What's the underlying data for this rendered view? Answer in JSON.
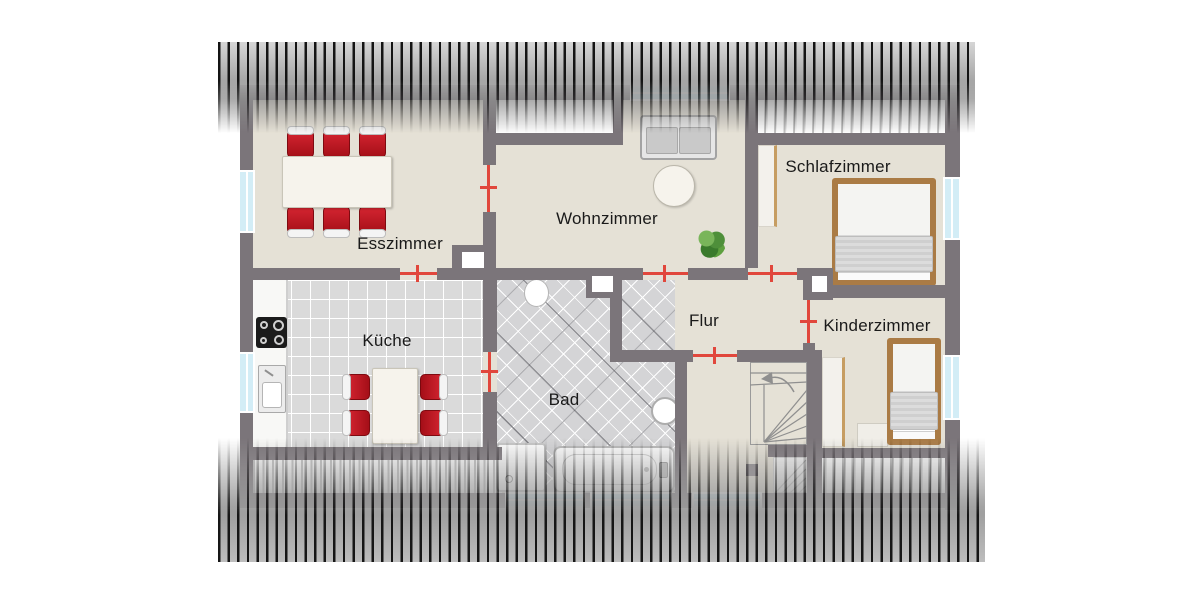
{
  "rooms": [
    {
      "id": "esszimmer",
      "label": "Esszimmer"
    },
    {
      "id": "wohnzimmer",
      "label": "Wohnzimmer"
    },
    {
      "id": "schlafzimmer",
      "label": "Schlafzimmer"
    },
    {
      "id": "kueche",
      "label": "Küche"
    },
    {
      "id": "bad",
      "label": "Bad"
    },
    {
      "id": "flur",
      "label": "Flur"
    },
    {
      "id": "kinderzimmer",
      "label": "Kinderzimmer"
    }
  ],
  "colors": {
    "wall": "#7b757a",
    "floor": "#e5e1d6",
    "kitchen_tile": "#dadada",
    "bath_tile": "#d4d4d6",
    "window_glass": "#d3edf6",
    "door_marker": "#e1473c",
    "chair_red": "#c01b24",
    "bed_frame": "#aa7b45",
    "wardrobe_edge": "#c69d62",
    "sofa_gray": "#d6d6d6",
    "plant_green": "#4e8f3a",
    "label_text": "#1a1a1a"
  },
  "furniture_icons": [
    "dining-table",
    "dining-chair",
    "sofa",
    "coffee-table",
    "plant",
    "double-bed",
    "single-bed",
    "wardrobe",
    "kitchen-counter",
    "cooktop",
    "kitchen-sink",
    "kitchen-table",
    "kitchen-chair",
    "toilet",
    "shower",
    "bathtub",
    "washbasin",
    "staircase",
    "desk"
  ]
}
